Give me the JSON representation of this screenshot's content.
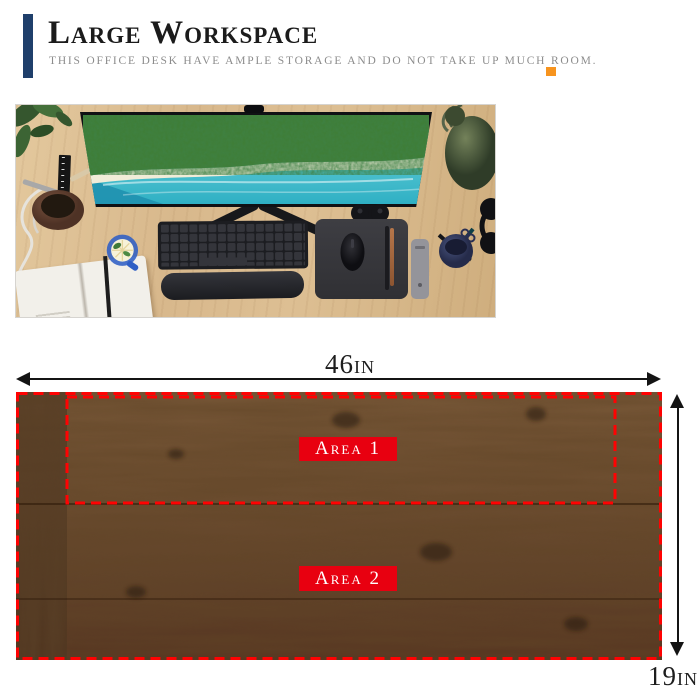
{
  "header": {
    "title": "Large Workspace",
    "subtitle": "THIS OFFICE DESK HAVE AMPLE STORAGE AND DO NOT TAKE UP MUCH ROOM.",
    "accent_bar_color": "#1f3f6b",
    "accent_square_color": "#f7941e"
  },
  "diagram": {
    "width_label": {
      "value": "46",
      "unit": "in"
    },
    "depth_label": {
      "value": "19",
      "unit": "in"
    },
    "areas": [
      {
        "label": "Area 1"
      },
      {
        "label": "Area 2"
      }
    ],
    "dash_color": "#ff0202",
    "area_label_bg": "#e80010",
    "area_label_text_color": "#ffffff"
  }
}
